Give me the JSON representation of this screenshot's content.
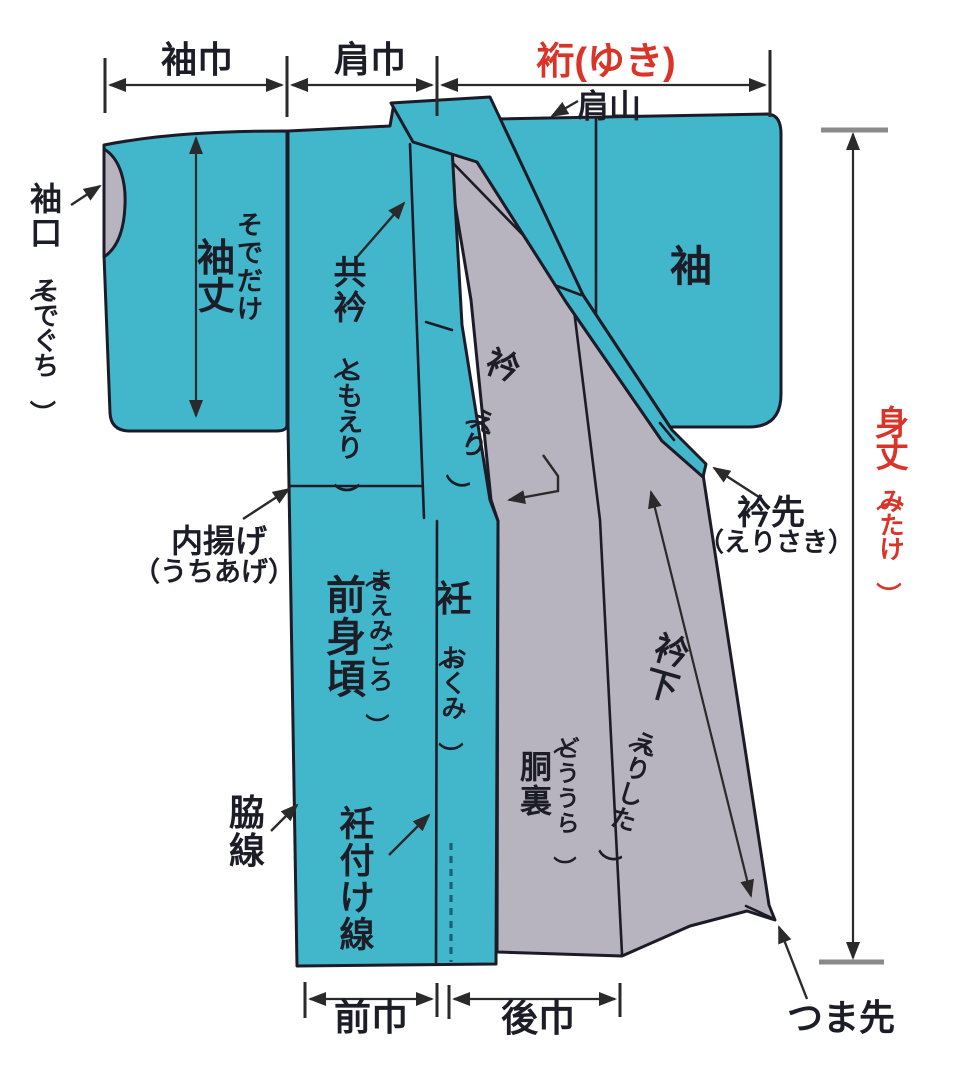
{
  "diagram": {
    "subject": "kimono-parts-diagram",
    "colors": {
      "fabric_teal": "#42b6ca",
      "lining_gray": "#b7b3bf",
      "outline": "#1c1c28",
      "accent_red": "#d93427",
      "annotation": "#2a2a2a",
      "dash_blue": "#1e5f78"
    },
    "measurements": {
      "sode_haba": "袖巾",
      "kata_haba": "肩巾",
      "yuki": "裄(ゆき)",
      "mitake": {
        "main": "身丈",
        "sub": "（みたけ）"
      },
      "sodetake": {
        "main": "袖丈",
        "ruby": "そでだけ"
      },
      "erishita": {
        "main": "衿下",
        "sub": "（えりした）"
      },
      "mae_haba": "前巾",
      "ushiro_haba": "後巾"
    },
    "parts": {
      "sodeguchi": {
        "main": "袖口",
        "sub": "（そでぐち）"
      },
      "kata_yama": "肩山",
      "sode_right": "袖",
      "tomoeri": {
        "main": "共衿",
        "sub": "（ともえり）"
      },
      "eri": {
        "main": "衿",
        "sub": "（えり）"
      },
      "erisaki": {
        "main": "衿先",
        "sub": "（えりさき）"
      },
      "uchiage": {
        "main": "内揚げ",
        "sub": "（うちあげ）"
      },
      "maemigoro": {
        "main": "前身頃",
        "ruby": "（まえみごろ）"
      },
      "okumi": {
        "main": "衽",
        "sub": "（おくみ）"
      },
      "douura": {
        "main": "胴裏",
        "ruby": "（どううら）"
      },
      "wakisen": "脇線",
      "okumitsuke_sen": "衽付け線",
      "tsumasaki": "つま先"
    }
  }
}
